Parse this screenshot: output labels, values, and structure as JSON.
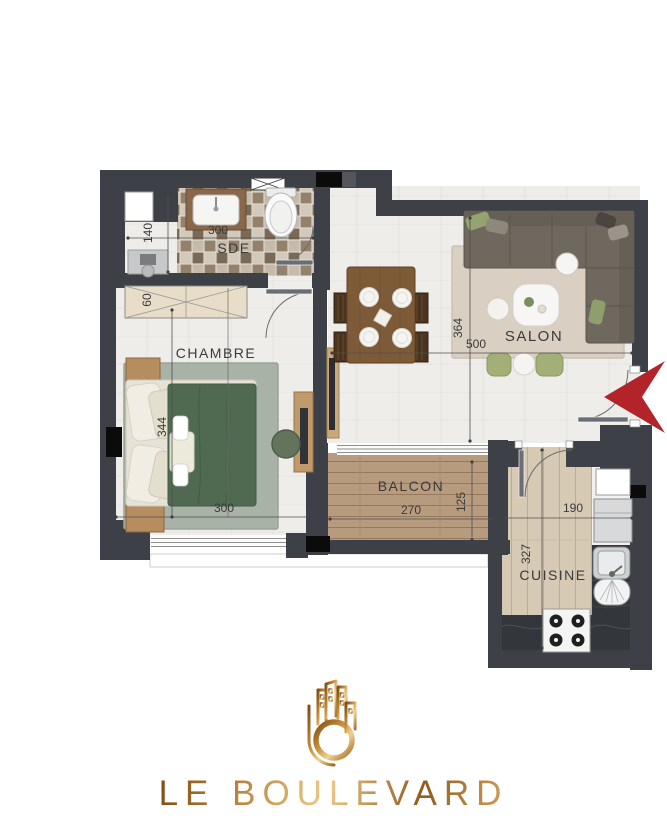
{
  "plan": {
    "rooms": {
      "sde": {
        "label": "SDE",
        "dim_width": "300",
        "dim_nook": "140"
      },
      "wardrobe": {
        "dim_depth": "60"
      },
      "chambre": {
        "label": "CHAMBRE",
        "dim_width": "300",
        "dim_length": "344"
      },
      "salon": {
        "label": "SALON",
        "dim_width": "500",
        "dim_length": "364"
      },
      "balcon": {
        "label": "BALCON",
        "dim_width": "270",
        "dim_depth": "125"
      },
      "cuisine": {
        "label": "CUISINE",
        "dim_width": "190",
        "dim_length": "327"
      }
    },
    "colors": {
      "wall": "#3d4046",
      "shaft": "#0b0b0b",
      "entrance_arrow": "#b2232a",
      "dim_text": "#3a3a3a",
      "gold_dark": "#7d4d15",
      "gold_light": "#ecca87"
    }
  },
  "brand": {
    "name": "LE BOULEVARD",
    "logo_icon": "gold-buildings-ring-monogram"
  }
}
